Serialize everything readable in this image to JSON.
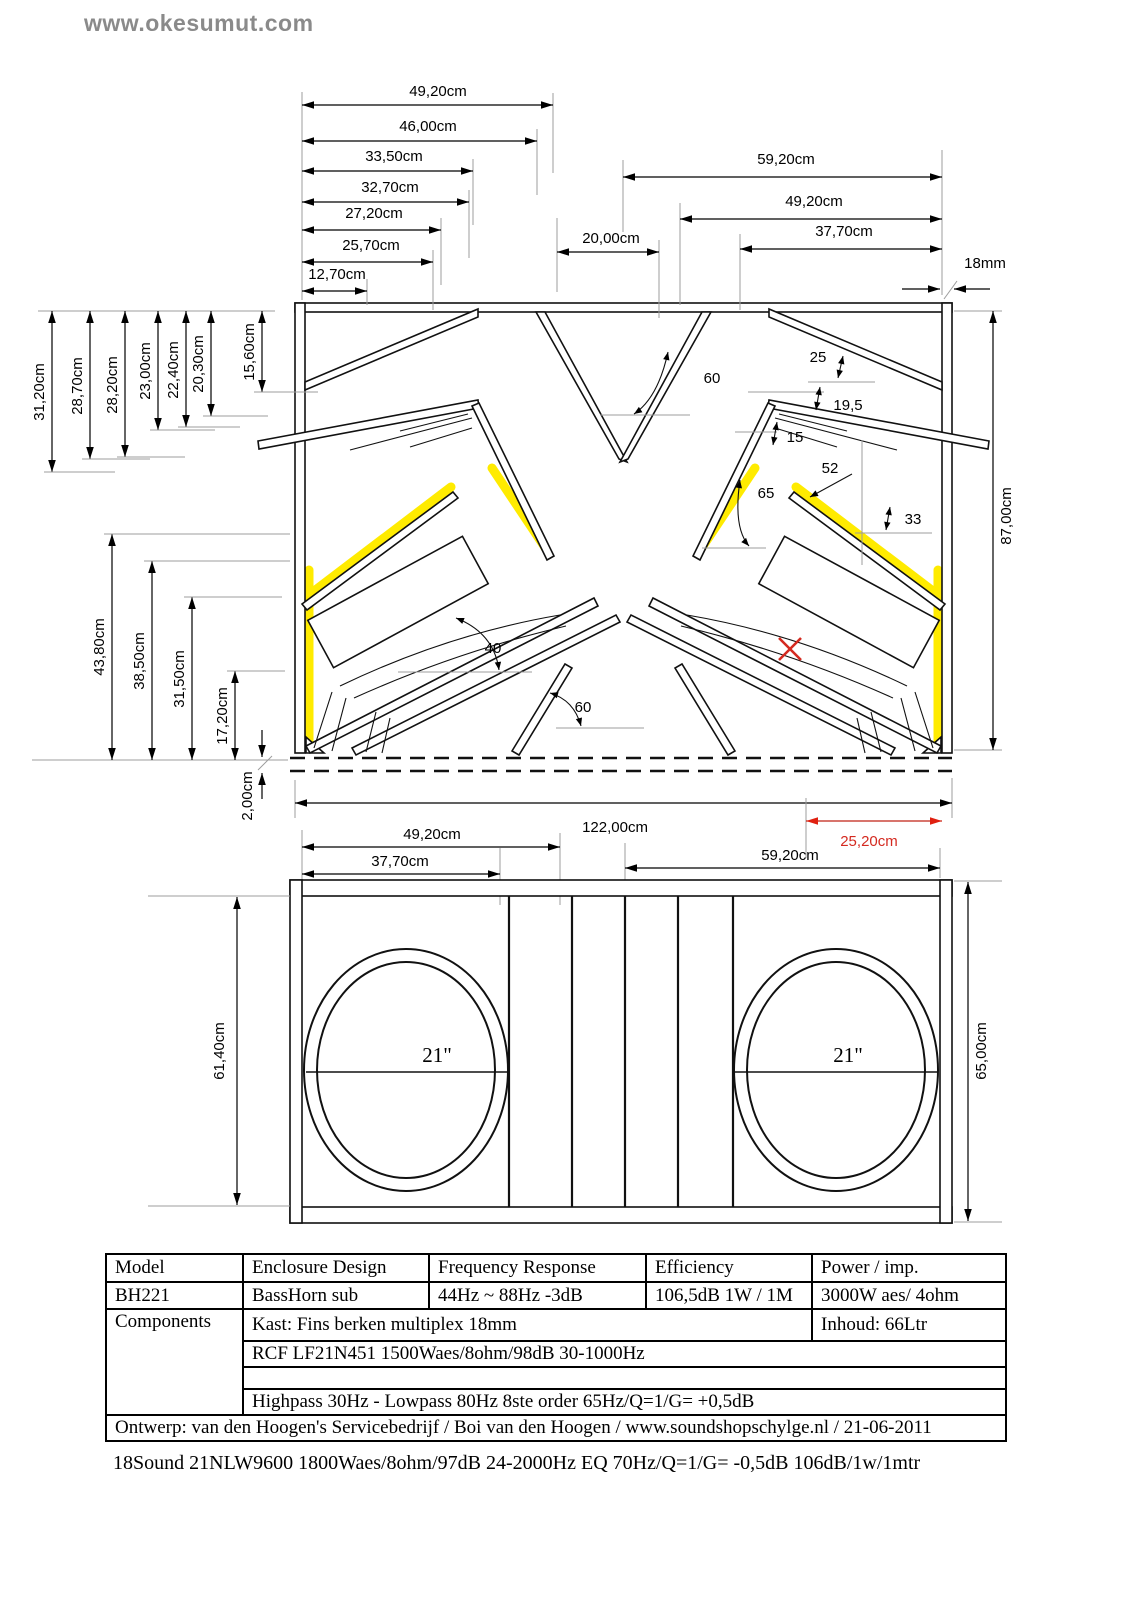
{
  "watermark": "www.okesumut.com",
  "colors": {
    "yellow": "#ffeb00",
    "red": "#d42a20",
    "line": "#000000",
    "gray": "#9c9c9c"
  },
  "cross_section": {
    "top_left_dims": [
      "49,20cm",
      "46,00cm",
      "33,50cm",
      "32,70cm",
      "27,20cm",
      "25,70cm",
      "12,70cm"
    ],
    "top_center_dim": "20,00cm",
    "top_right_dims": [
      "59,20cm",
      "49,20cm",
      "37,70cm"
    ],
    "wall_thickness": "18mm",
    "left_top_dims": [
      "31,20cm",
      "28,70cm",
      "28,20cm",
      "23,00cm",
      "22,40cm",
      "20,30cm",
      "15,60cm"
    ],
    "left_bottom_dims": [
      "43,80cm",
      "38,50cm",
      "31,50cm",
      "17,20cm"
    ],
    "bottom_offset_dim": "2,00cm",
    "height_dim": "87,00cm",
    "total_width_dim": "122,00cm",
    "port_dim": "25,20cm",
    "below_left_dims": [
      "49,20cm",
      "37,70cm"
    ],
    "below_right_dim": "59,20cm",
    "angles": {
      "flare_top": "60",
      "top_right": "25",
      "reflector": "19,5",
      "wedge": "15",
      "panel52": "52",
      "throat": "65",
      "panel33": "33",
      "baffle": "40",
      "port": "60"
    }
  },
  "front_view": {
    "left_driver": "21\"",
    "right_driver": "21\"",
    "height_inner": "61,40cm",
    "height_outer": "65,00cm"
  },
  "spec_table": {
    "headers": [
      "Model",
      "Enclosure Design",
      "Frequency Response",
      "Efficiency",
      "Power / imp."
    ],
    "row_model": [
      "BH221",
      "BassHorn sub",
      "44Hz ~ 88Hz -3dB",
      "106,5dB 1W / 1M",
      "3000W aes/ 4ohm"
    ],
    "components_label": "Components",
    "kast": "Kast: Fins berken multiplex 18mm",
    "inhoud": "Inhoud: 66Ltr",
    "driver_row": "RCF LF21N451 1500Waes/8ohm/98dB 30-1000Hz",
    "empty_row": "",
    "crossover_row": "Highpass 30Hz - Lowpass 80Hz 8ste order 65Hz/Q=1/G= +0,5dB",
    "design_row": "Ontwerp: van den Hoogen's Servicebedrijf / Boi van den Hoogen / www.soundshopschylge.nl / 21-06-2011"
  },
  "footnote": "18Sound 21NLW9600 1800Waes/8ohm/97dB 24-2000Hz EQ 70Hz/Q=1/G= -0,5dB 106dB/1w/1mtr"
}
